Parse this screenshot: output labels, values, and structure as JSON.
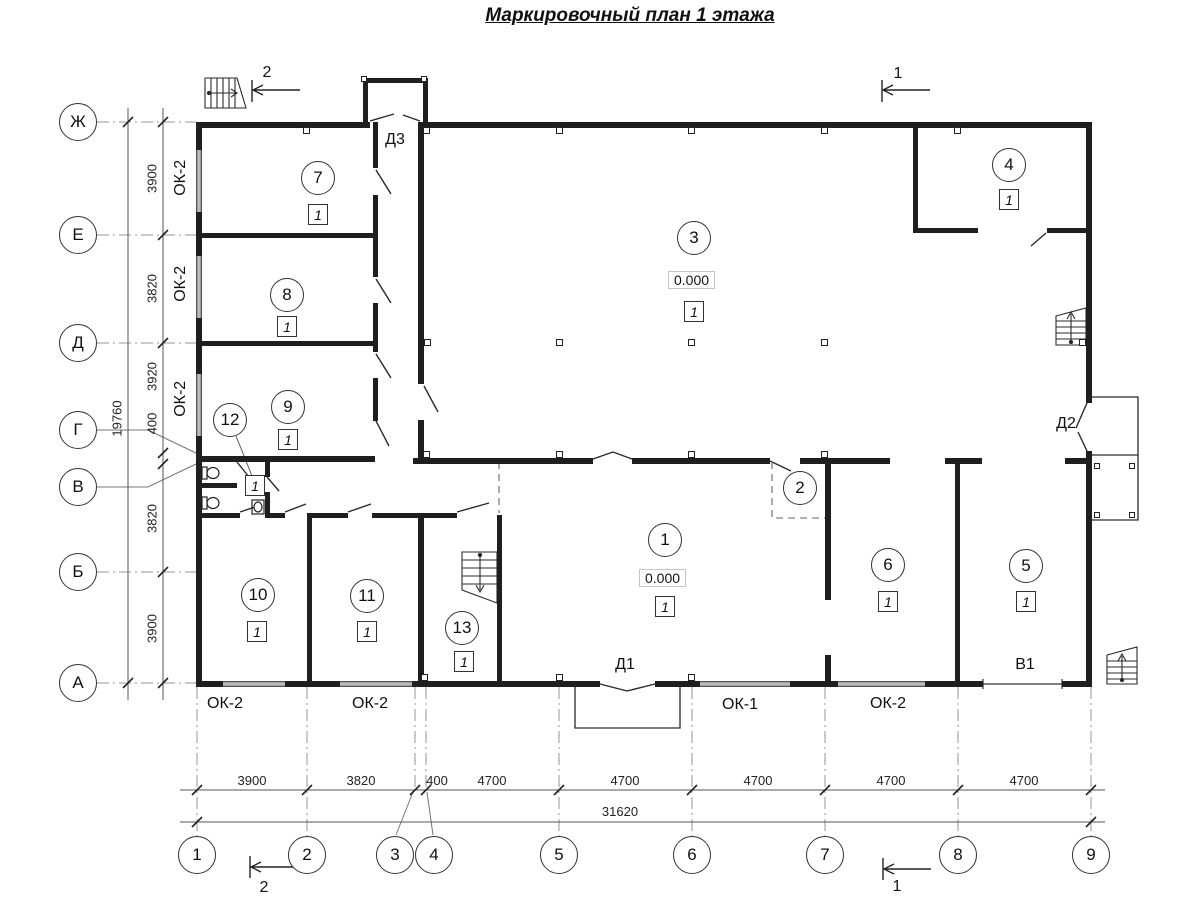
{
  "title": "Маркировочный план 1 этажа",
  "grid": {
    "row_letters": [
      "Ж",
      "Е",
      "Д",
      "Г",
      "В",
      "Б",
      "А"
    ],
    "col_numbers": [
      "1",
      "2",
      "3",
      "4",
      "5",
      "6",
      "7",
      "8",
      "9"
    ],
    "row_dims": [
      "3900",
      "3820",
      "3920",
      "400",
      "3820",
      "3900"
    ],
    "row_total": "19760",
    "col_dims": [
      "3900",
      "3820",
      "400",
      "4700",
      "4700",
      "4700",
      "4700",
      "4700"
    ],
    "col_total": "31620"
  },
  "rooms": [
    {
      "num": "1",
      "badge": "1",
      "elevation": "0.000"
    },
    {
      "num": "2"
    },
    {
      "num": "3",
      "badge": "1",
      "elevation": "0.000"
    },
    {
      "num": "4",
      "badge": "1"
    },
    {
      "num": "5",
      "badge": "1"
    },
    {
      "num": "6",
      "badge": "1"
    },
    {
      "num": "7",
      "badge": "1"
    },
    {
      "num": "8",
      "badge": "1"
    },
    {
      "num": "9",
      "badge": "1"
    },
    {
      "num": "10",
      "badge": "1"
    },
    {
      "num": "11",
      "badge": "1"
    },
    {
      "num": "12",
      "badge": "1"
    },
    {
      "num": "13",
      "badge": "1"
    }
  ],
  "openings": {
    "door1": "Д1",
    "door2": "Д2",
    "door3": "Д3",
    "gate1": "В1",
    "window_ok1": "ОК-1",
    "window_ok2": "ОК-2"
  },
  "sections": {
    "one": "1",
    "two": "2"
  }
}
